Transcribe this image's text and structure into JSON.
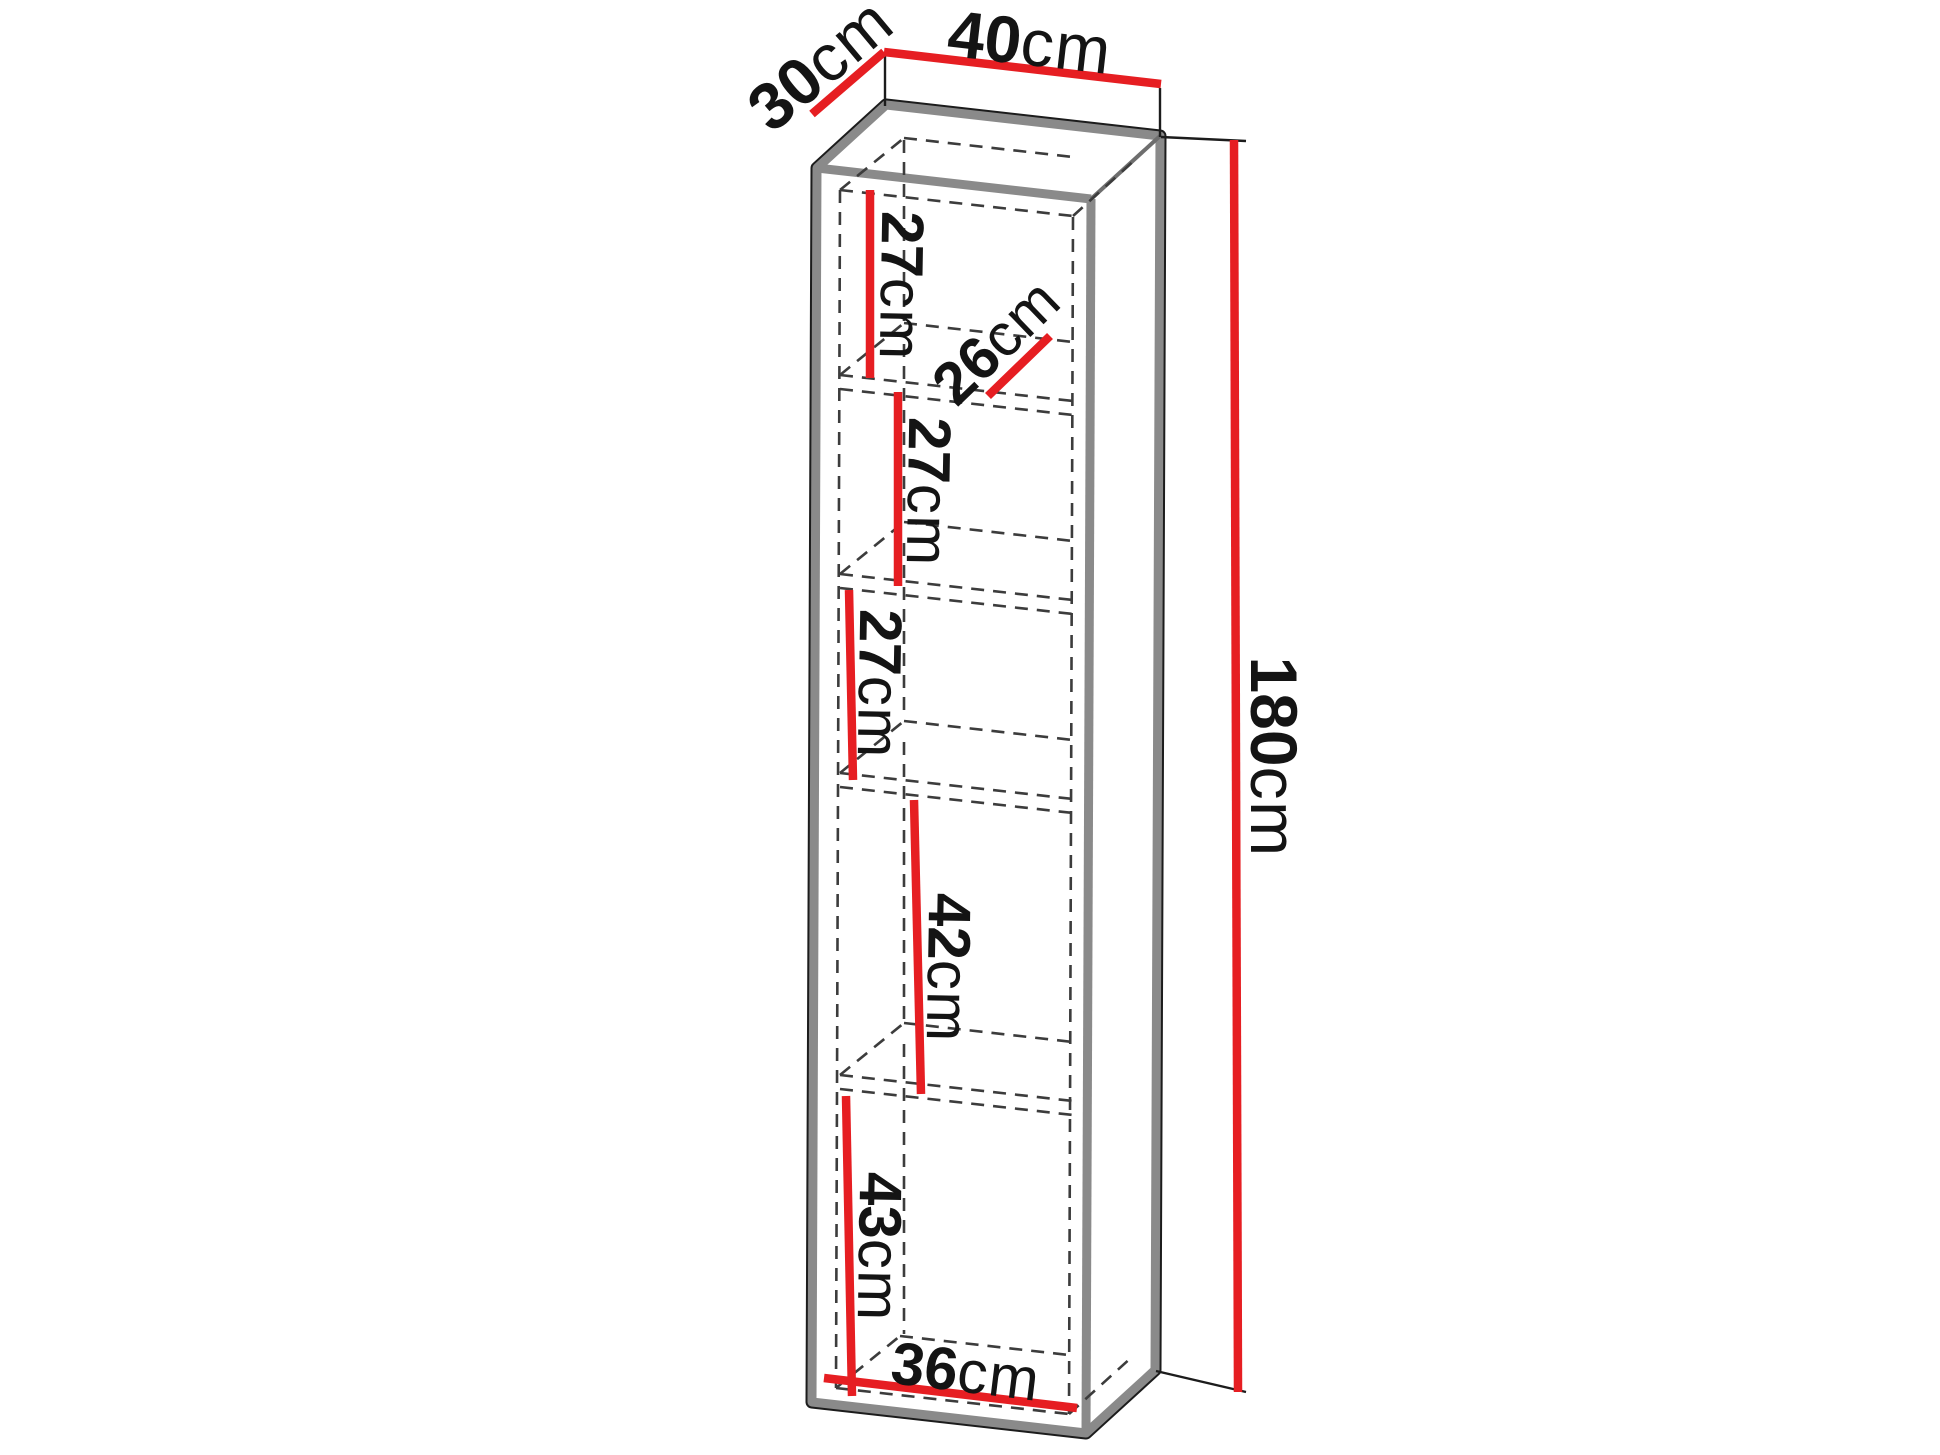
{
  "colors": {
    "background": "#ffffff",
    "dimension_line": "#e61e22",
    "outline_black": "#1c1c1c",
    "outline_gray": "#8a8a8a",
    "outline_gray_light": "#6e6e6e",
    "dashed_line": "#3c3c3c",
    "label_text": "#141414"
  },
  "cabinet": {
    "overall": {
      "width": {
        "value": "40",
        "unit": "cm"
      },
      "depth": {
        "value": "30",
        "unit": "cm"
      },
      "height": {
        "value": "180",
        "unit": "cm"
      }
    },
    "interior": {
      "shelf_depth": {
        "value": "26",
        "unit": "cm"
      },
      "bottom_width": {
        "value": "36",
        "unit": "cm"
      },
      "compartment_heights": [
        {
          "value": "27",
          "unit": "cm"
        },
        {
          "value": "27",
          "unit": "cm"
        },
        {
          "value": "27",
          "unit": "cm"
        },
        {
          "value": "42",
          "unit": "cm"
        },
        {
          "value": "43",
          "unit": "cm"
        }
      ]
    }
  }
}
